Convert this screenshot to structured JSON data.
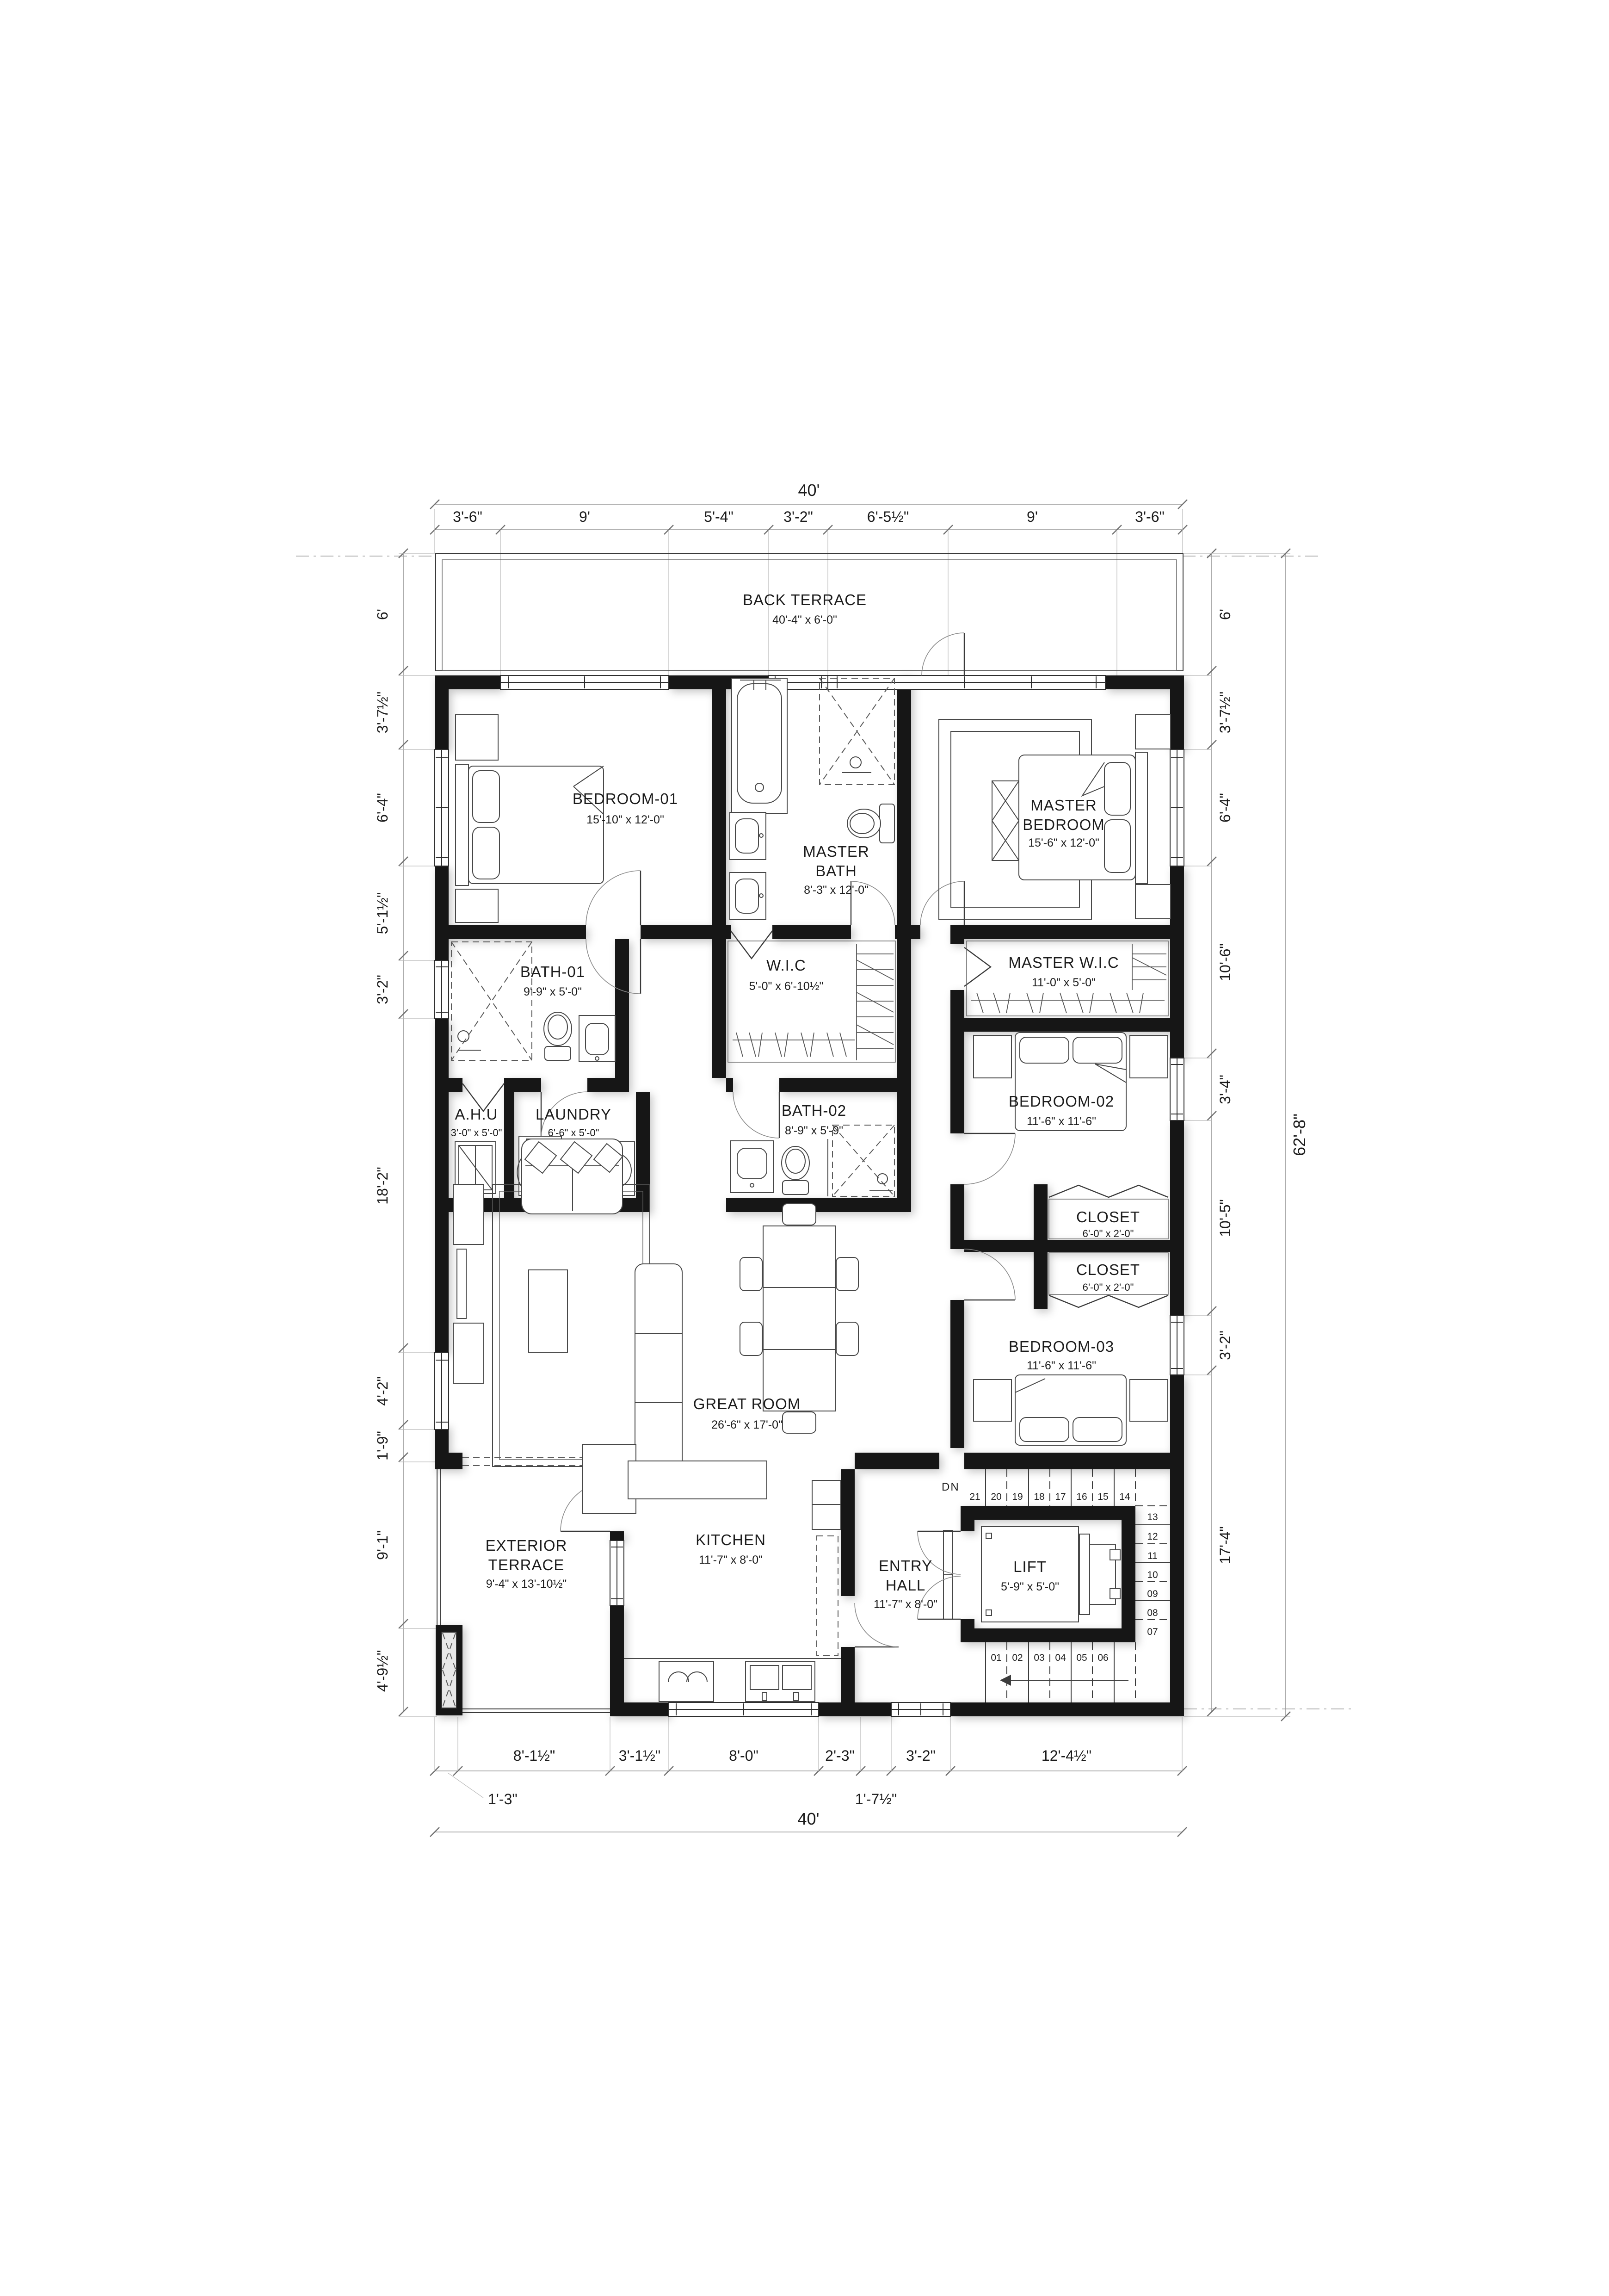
{
  "document": {
    "type": "architectural floor plan",
    "sheet_background": "#ffffff"
  },
  "colors": {
    "wall": "#151515",
    "dimension_line": "#9a9a9a",
    "text": "#1c1c1c",
    "furniture_line": "#474747"
  },
  "rooms": {
    "back_terrace": {
      "name": "BACK TERRACE",
      "size": "40'-4\" x 6'-0\""
    },
    "bedroom01": {
      "name": "BEDROOM-01",
      "size": "15'-10\" x 12'-0\""
    },
    "master_bath": {
      "line1": "MASTER",
      "line2": "BATH",
      "size": "8'-3\" x 12'-0\""
    },
    "master_bedroom": {
      "line1": "MASTER",
      "line2": "BEDROOM",
      "size": "15'-6\" x 12'-0\""
    },
    "bath01": {
      "name": "BATH-01",
      "size": "9'-9\" x 5'-0\""
    },
    "wic": {
      "name": "W.I.C",
      "size": "5'-0\" x 6'-10½\""
    },
    "master_wic": {
      "name": "MASTER W.I.C",
      "size": "11'-0\" x 5'-0\""
    },
    "ahu": {
      "name": "A.H.U",
      "size": "3'-0\" x 5'-0\""
    },
    "laundry": {
      "name": "LAUNDRY",
      "size": "6'-6\" x 5'-0\""
    },
    "bath02": {
      "name": "BATH-02",
      "size": "8'-9\" x 5'-9\""
    },
    "bedroom02": {
      "name": "BEDROOM-02",
      "size": "11'-6\" x 11'-6\""
    },
    "closet_top": {
      "name": "CLOSET",
      "size": "6'-0\" x 2'-0\""
    },
    "closet_bottom": {
      "name": "CLOSET",
      "size": "6'-0\" x 2'-0\""
    },
    "bedroom03": {
      "name": "BEDROOM-03",
      "size": "11'-6\" x 11'-6\""
    },
    "great_room": {
      "name": "GREAT ROOM",
      "size": "26'-6\" x 17'-0\""
    },
    "exterior_terrace": {
      "line1": "EXTERIOR",
      "line2": "TERRACE",
      "size": "9'-4\" x 13'-10½\""
    },
    "kitchen": {
      "name": "KITCHEN",
      "size": "11'-7\" x 8'-0\""
    },
    "entry_hall": {
      "line1": "ENTRY",
      "line2": "HALL",
      "size": "11'-7\" x 8'-0\""
    },
    "lift": {
      "name": "LIFT",
      "size": "5'-9\" x 5'-0\""
    }
  },
  "dims": {
    "top_overall": "40'",
    "top": [
      "3'-6\"",
      "9'",
      "5'-4\"",
      "3'-2\"",
      "6'-5½\"",
      "9'",
      "3'-6\""
    ],
    "left": [
      "6'",
      "3'-7½\"",
      "6'-4\"",
      "5'-1½\"",
      "3'-2\"",
      "18'-2\"",
      "4'-2\"",
      "1'-9\"",
      "9'-1\"",
      "4'-9½\""
    ],
    "right": [
      "6'",
      "3'-7½\"",
      "6'-4\"",
      "10'-6\"",
      "3'-4\"",
      "10'-5\"",
      "3'-2\"",
      "17'-4\""
    ],
    "right_overall": "62'-8\"",
    "bottom": [
      "8'-1½\"",
      "3'-1½\"",
      "8'-0\"",
      "2'-3\"",
      "3'-2\"",
      "12'-4½\""
    ],
    "bottom_leader_left": "1'-3\"",
    "bottom_leader_mid": "1'-7½\"",
    "bottom_overall": "40'"
  },
  "stairs": {
    "dn": "DN",
    "flight_top": [
      "21",
      "20",
      "19",
      "18",
      "17",
      "16",
      "15",
      "14"
    ],
    "corner": "13",
    "flight_right": [
      "12",
      "11",
      "10",
      "09",
      "08",
      "07"
    ],
    "flight_bottom": [
      "01",
      "02",
      "03",
      "04",
      "05",
      "06"
    ]
  }
}
